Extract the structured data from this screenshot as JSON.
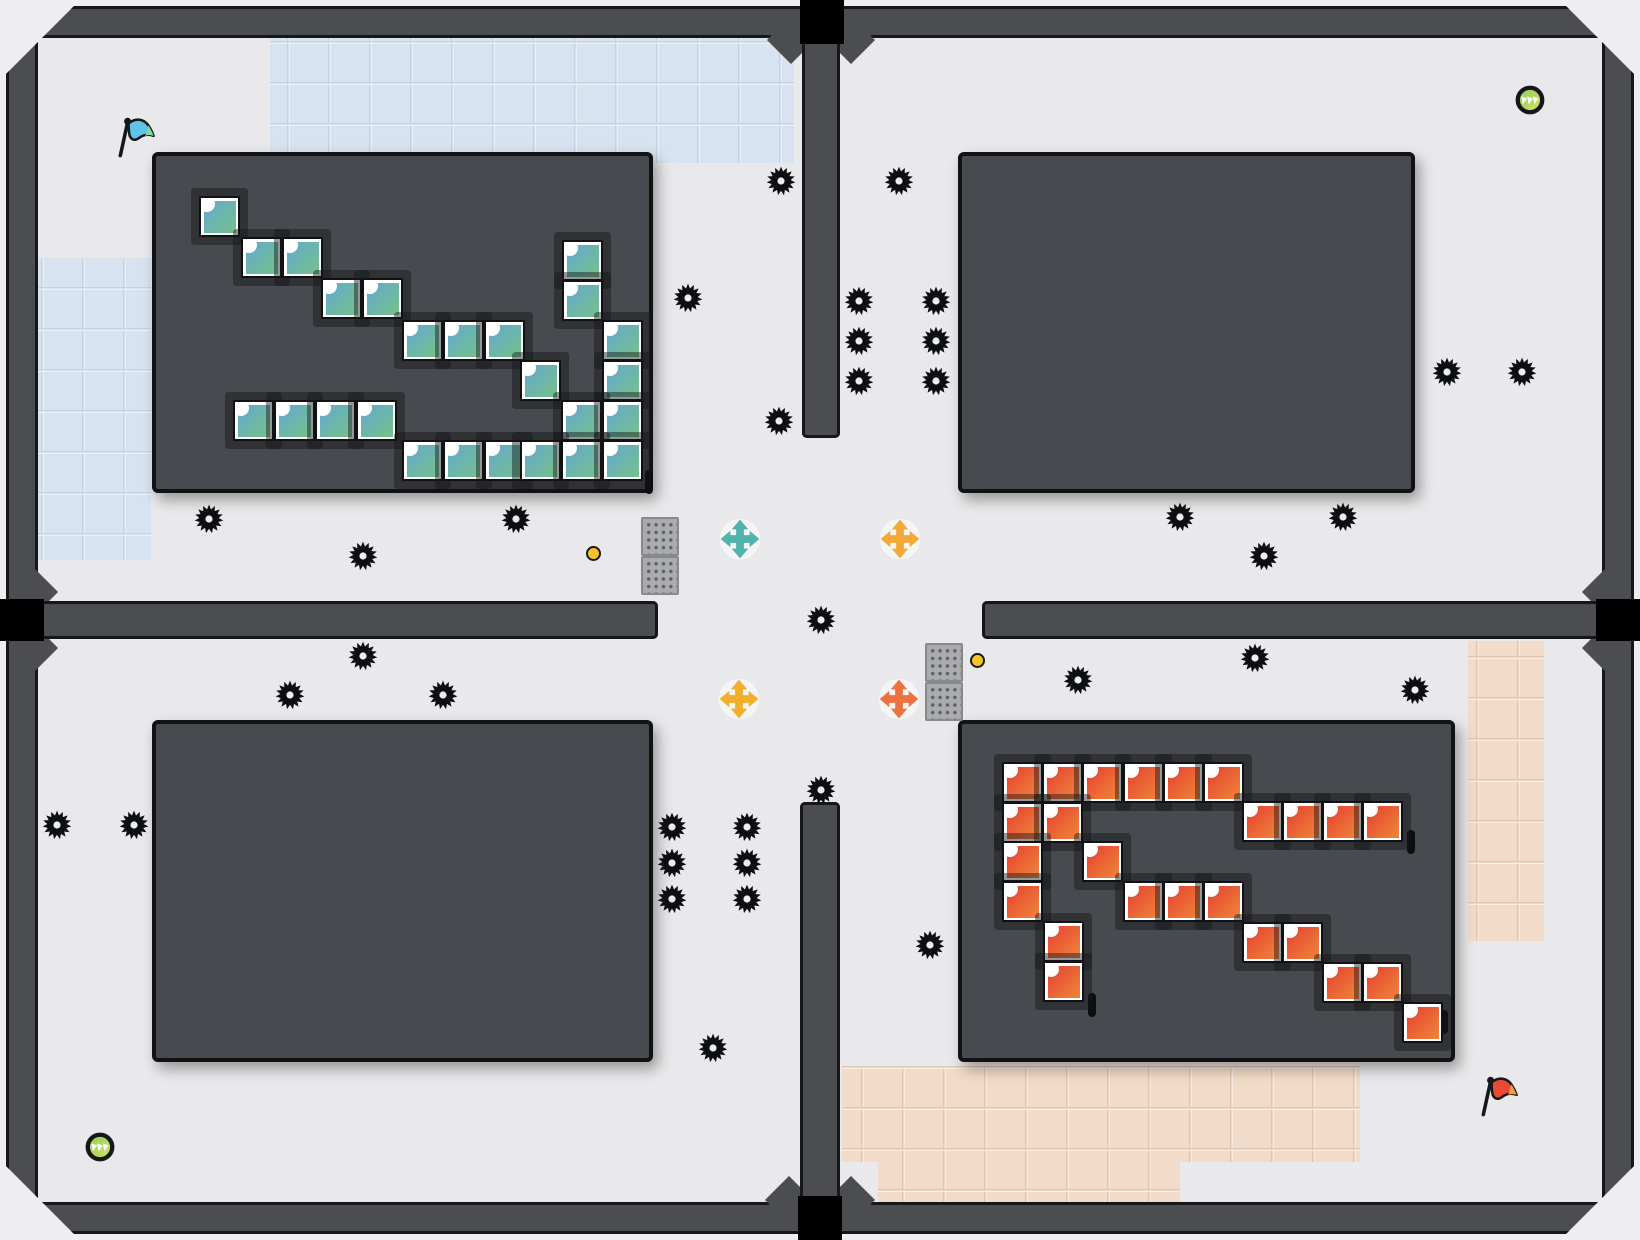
{
  "board": {
    "width": 1640,
    "height": 1240,
    "tile_size": 41,
    "colors": {
      "page": "#eeeef0",
      "wall": "#4b4d51",
      "wall_edge": "#15171a",
      "floor": "#e9e9eb",
      "floor_line": "#d8d8da",
      "room": "#474a4e",
      "room_edge": "#101214",
      "blue_region": "#d7e3f0",
      "blue_line": "#c2d3e3",
      "peach_region": "#f2dbc8",
      "peach_line": "#e2c5ae",
      "void_gap": "#000000",
      "gear": "#0d0e10",
      "gear_hole": "#ecedee",
      "dot_fill": "#f6c32b",
      "orb_ring": "#15171a",
      "orb_fill_a": "#8ccb5e",
      "orb_fill_b": "#d7e45f",
      "teal_tile_a": "#64a8d2",
      "teal_tile_b": "#77c08a",
      "red_tile_a": "#e2402f",
      "red_tile_b": "#f0843c"
    },
    "outer_walls": [
      [
        6,
        6,
        1628,
        32
      ],
      [
        6,
        1202,
        1628,
        32
      ],
      [
        6,
        6,
        32,
        1228
      ],
      [
        1602,
        6,
        32,
        1228
      ]
    ],
    "dividers": [
      [
        802,
        30,
        38,
        408
      ],
      [
        800,
        802,
        40,
        404
      ],
      [
        6,
        601,
        652,
        38
      ],
      [
        982,
        601,
        652,
        38
      ]
    ],
    "flares": [
      [
        791,
        40
      ],
      [
        851,
        40
      ],
      [
        789,
        1200
      ],
      [
        851,
        1200
      ],
      [
        34,
        592
      ],
      [
        34,
        648
      ],
      [
        1606,
        592
      ],
      [
        1606,
        648
      ]
    ],
    "gaps": [
      [
        800,
        0,
        44,
        44
      ],
      [
        798,
        1196,
        44,
        44
      ],
      [
        0,
        599,
        44,
        42
      ],
      [
        1596,
        599,
        44,
        42
      ]
    ],
    "rooms": [
      [
        152,
        152,
        501,
        341
      ],
      [
        958,
        152,
        457,
        341
      ],
      [
        152,
        720,
        501,
        342
      ],
      [
        958,
        720,
        497,
        342
      ]
    ],
    "tinted_regions": [
      {
        "x": 270,
        "y": 38,
        "w": 524,
        "h": 125,
        "kind": "blue"
      },
      {
        "x": 38,
        "y": 258,
        "w": 113,
        "h": 302,
        "kind": "blue"
      },
      {
        "x": 1468,
        "y": 641,
        "w": 76,
        "h": 300,
        "kind": "peach"
      },
      {
        "x": 842,
        "y": 1066,
        "w": 518,
        "h": 96,
        "kind": "peach"
      },
      {
        "x": 878,
        "y": 1162,
        "w": 302,
        "h": 40,
        "kind": "peach"
      }
    ]
  },
  "objects": {
    "gears": [
      [
        781,
        181
      ],
      [
        899,
        181
      ],
      [
        688,
        298
      ],
      [
        859,
        301
      ],
      [
        936,
        301
      ],
      [
        859,
        341
      ],
      [
        936,
        341
      ],
      [
        859,
        381
      ],
      [
        936,
        381
      ],
      [
        779,
        421
      ],
      [
        1447,
        372
      ],
      [
        1522,
        372
      ],
      [
        209,
        519
      ],
      [
        516,
        519
      ],
      [
        363,
        556
      ],
      [
        1180,
        517
      ],
      [
        1343,
        517
      ],
      [
        1264,
        556
      ],
      [
        821,
        620
      ],
      [
        363,
        656
      ],
      [
        290,
        695
      ],
      [
        443,
        695
      ],
      [
        1078,
        680
      ],
      [
        1255,
        658
      ],
      [
        1415,
        690
      ],
      [
        57,
        825
      ],
      [
        134,
        825
      ],
      [
        672,
        827
      ],
      [
        747,
        827
      ],
      [
        672,
        863
      ],
      [
        747,
        863
      ],
      [
        672,
        899
      ],
      [
        747,
        899
      ],
      [
        821,
        790
      ],
      [
        930,
        945
      ],
      [
        713,
        1048
      ]
    ],
    "teal_tiles": [
      [
        199,
        196
      ],
      [
        241,
        237
      ],
      [
        282,
        237
      ],
      [
        321,
        278
      ],
      [
        362,
        278
      ],
      [
        402,
        320
      ],
      [
        443,
        320
      ],
      [
        484,
        320
      ],
      [
        520,
        360
      ],
      [
        562,
        240
      ],
      [
        562,
        280
      ],
      [
        602,
        320
      ],
      [
        602,
        360
      ],
      [
        561,
        400
      ],
      [
        602,
        400
      ],
      [
        233,
        400
      ],
      [
        274,
        400
      ],
      [
        315,
        400
      ],
      [
        356,
        400
      ],
      [
        402,
        440
      ],
      [
        443,
        440
      ],
      [
        484,
        440
      ],
      [
        520,
        440
      ],
      [
        561,
        440
      ],
      [
        602,
        440
      ]
    ],
    "red_tiles": [
      [
        1002,
        762
      ],
      [
        1042,
        762
      ],
      [
        1082,
        762
      ],
      [
        1123,
        762
      ],
      [
        1163,
        762
      ],
      [
        1203,
        762
      ],
      [
        1002,
        802
      ],
      [
        1042,
        802
      ],
      [
        1242,
        801
      ],
      [
        1282,
        801
      ],
      [
        1322,
        801
      ],
      [
        1362,
        801
      ],
      [
        1002,
        841
      ],
      [
        1082,
        841
      ],
      [
        1002,
        881
      ],
      [
        1123,
        881
      ],
      [
        1163,
        881
      ],
      [
        1203,
        881
      ],
      [
        1043,
        921
      ],
      [
        1043,
        961
      ],
      [
        1242,
        922
      ],
      [
        1282,
        922
      ],
      [
        1322,
        962
      ],
      [
        1362,
        962
      ],
      [
        1402,
        1002
      ]
    ],
    "crosses": [
      {
        "x": 740,
        "y": 539,
        "color": "#4fb4ab",
        "name": "move-cross-teal"
      },
      {
        "x": 900,
        "y": 539,
        "color": "#f2a93a",
        "name": "move-cross-amber"
      },
      {
        "x": 739,
        "y": 699,
        "color": "#f2b02a",
        "name": "move-cross-yellow"
      },
      {
        "x": 899,
        "y": 699,
        "color": "#ee7140",
        "name": "move-cross-orange"
      }
    ],
    "flags": [
      {
        "x": 138,
        "y": 139,
        "cloth": "#5fc2e8",
        "tip": "#7fd89f",
        "name": "blue-flag-icon"
      },
      {
        "x": 1501,
        "y": 1098,
        "cloth": "#e94a33",
        "tip": "#f5a03e",
        "name": "red-flag-icon"
      }
    ],
    "orbs": [
      [
        1530,
        100
      ],
      [
        100,
        1147
      ]
    ],
    "dots": [
      [
        593,
        553
      ],
      [
        977,
        660
      ]
    ],
    "grates": [
      [
        641,
        517
      ],
      [
        641,
        556
      ],
      [
        925,
        643
      ],
      [
        925,
        682
      ]
    ],
    "slots": [
      [
        645,
        470
      ],
      [
        1407,
        830
      ],
      [
        1088,
        993
      ],
      [
        1440,
        1010
      ]
    ]
  }
}
